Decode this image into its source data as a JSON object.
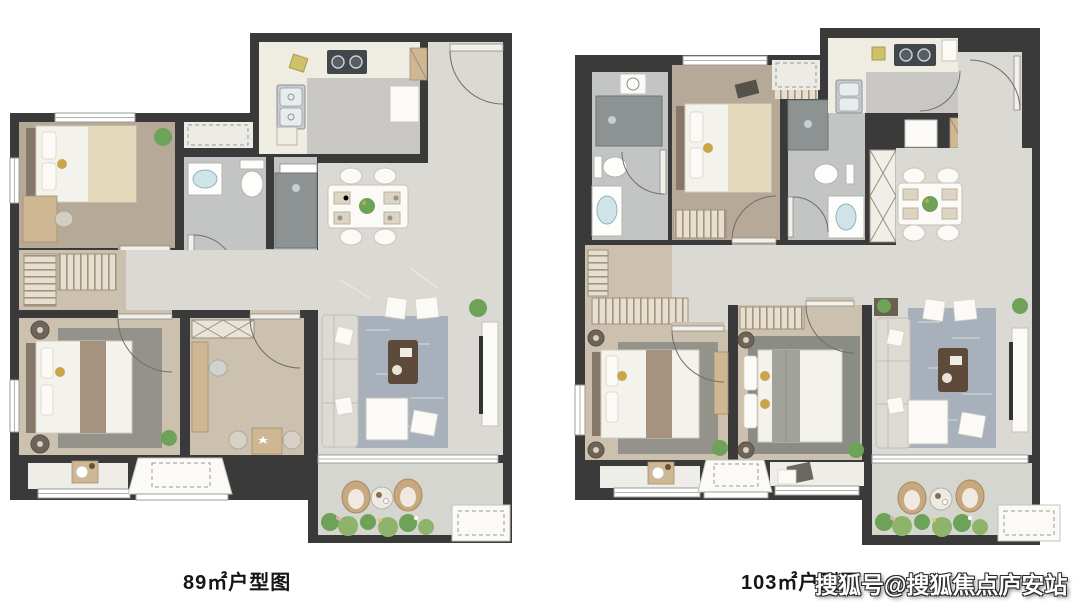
{
  "page": {
    "width": 1080,
    "height": 610,
    "background": "#ffffff"
  },
  "plans": [
    {
      "caption": "89㎡户型图"
    },
    {
      "caption": "103㎡户型图"
    }
  ],
  "watermark": {
    "text": "搜狐号@搜狐焦点庐安站",
    "color": "#ffffff"
  },
  "colors": {
    "wall": "#3a3a3a",
    "wood": "#ccc0af",
    "wood2": "#b7a998",
    "marble": "#dbd9d3",
    "bath": "#c3c5c4",
    "counter": "#efece1",
    "kfloor": "#c8c7c3",
    "balcony": "#d6d6d1",
    "ruggray": "#93928b",
    "rugblue": "#a8b1bb",
    "shower": "#8d9292",
    "plant": "#6da258",
    "wicker": "#c8a87f",
    "accentGold": "#c9a64b",
    "basin": "#cfe3e8",
    "wmcolor": "#ffffff"
  }
}
